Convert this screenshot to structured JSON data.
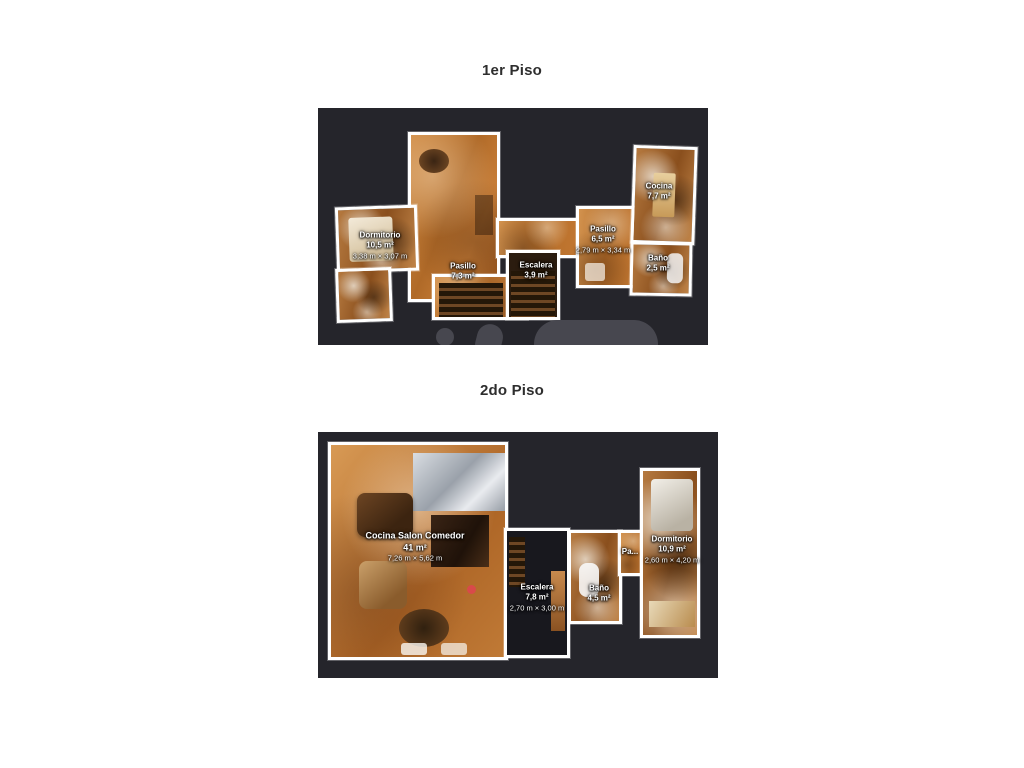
{
  "document": {
    "type": "real-estate floor plans, 3D scan style",
    "language": "Spanish"
  },
  "floors": [
    {
      "title": "1er Piso",
      "rooms": [
        {
          "name": "Dormitorio",
          "area": "10,5 m²",
          "dims": "3,38 m × 3,07 m"
        },
        {
          "name": "Pasillo",
          "area": "7,3 m²"
        },
        {
          "name": "Escalera",
          "area": "3,9 m²"
        },
        {
          "name": "Pasillo",
          "area": "6,5 m²",
          "dims": "2,79 m × 3,34 m"
        },
        {
          "name": "Cocina",
          "area": "7,7 m²"
        },
        {
          "name": "Baño",
          "area": "2,5 m²"
        }
      ]
    },
    {
      "title": "2do Piso",
      "rooms": [
        {
          "name": "Cocina Salon Comedor",
          "area": "41 m²",
          "dims": "7,26 m × 5,62 m"
        },
        {
          "name": "Escalera",
          "area": "7,8 m²",
          "dims": "2,70 m × 3,00 m"
        },
        {
          "name": "Baño",
          "area": "4,5 m²"
        },
        {
          "name": "Pa..."
        },
        {
          "name": "Dormitorio",
          "area": "10,9 m²",
          "dims": "2,60 m × 4,20 m"
        }
      ]
    }
  ],
  "colors": {
    "page_background": "#ffffff",
    "panel_background": "#25252b",
    "wall": "#ffffff",
    "floor_light": "#d2924e",
    "floor_dark": "#9a561d",
    "label_text": "#ffffff",
    "title_text": "#2e2e2e",
    "watermark": "#47474f"
  }
}
